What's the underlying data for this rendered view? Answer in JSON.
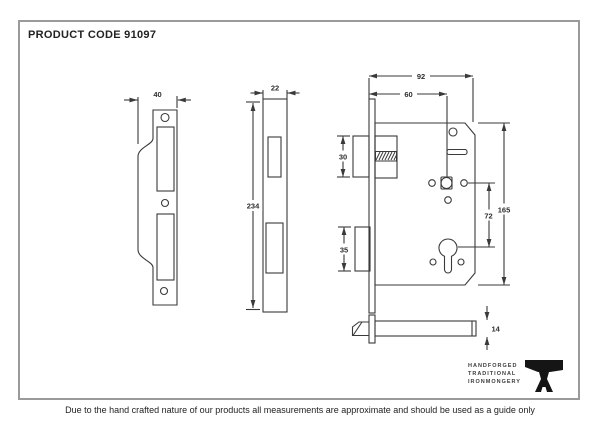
{
  "header": {
    "product_code": "PRODUCT CODE 91097"
  },
  "footer": {
    "disclaimer": "Due to the hand crafted nature of our products all measurements are approximate and should be used as a guide only"
  },
  "logo": {
    "line1": "HANDFORGED",
    "line2": "TRADITIONAL",
    "line3": "IRONMONGERY"
  },
  "dims": {
    "strike_plate_width": "40",
    "forend_width": "22",
    "forend_height": "234",
    "overall_depth": "92",
    "backset": "60",
    "latch_height": "30",
    "deadbolt_height": "35",
    "centres": "72",
    "case_height": "165",
    "case_thickness": "14"
  },
  "colors": {
    "line": "#3a3a3a",
    "border": "#9a9a9a"
  }
}
